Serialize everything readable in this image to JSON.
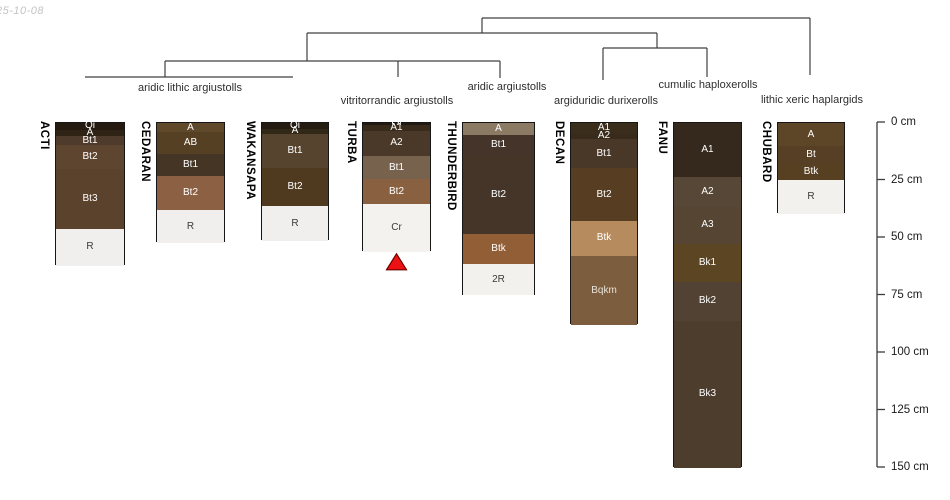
{
  "timestamp": "25-10-08",
  "chart_data": {
    "type": "bar",
    "variant": "soil profile sketches (stacked depth columns) grouped by a taxonomy dendrogram, aqp-style",
    "depth_axis": {
      "unit": "cm",
      "range": [
        0,
        150
      ],
      "ticks": [
        0,
        25,
        50,
        75,
        100,
        125,
        150
      ],
      "tick_labels": [
        "0 cm",
        "25 cm",
        "50 cm",
        "75 cm",
        "100 cm",
        "125 cm",
        "150 cm"
      ]
    },
    "taxa_groups": [
      "aridic lithic argiustolls",
      "vitritorrandic argiustolls",
      "aridic argiustolls",
      "argiduridic durixerolls",
      "cumulic haploxerolls",
      "lithic xeric haplargids"
    ],
    "profiles": [
      {
        "id": "ACTI",
        "group": "aridic lithic argiustolls",
        "x": 55,
        "w": 70,
        "horizons": [
          {
            "name": "Oi",
            "top": 0,
            "bottom": 3,
            "color": "#241a10",
            "text_color": "#ffffff"
          },
          {
            "name": "A",
            "top": 3,
            "bottom": 5.7,
            "color": "#2f2315",
            "text_color": "#ffffff"
          },
          {
            "name": "Bt1",
            "top": 5.7,
            "bottom": 9.7,
            "color": "#4e3b2b",
            "text_color": "#ffffff"
          },
          {
            "name": "Bt2",
            "top": 9.7,
            "bottom": 20,
            "color": "#5e4530",
            "text_color": "#ffffff"
          },
          {
            "name": "Bt3",
            "top": 20,
            "bottom": 46,
            "color": "#5a422d",
            "text_color": "#ffffff"
          },
          {
            "name": "R",
            "top": 46,
            "bottom": 62,
            "color": "#f0efed",
            "text_color": "#3a3a3a"
          }
        ]
      },
      {
        "id": "CEDARAN",
        "group": "aridic lithic argiustolls",
        "x": 156,
        "w": 69,
        "horizons": [
          {
            "name": "A",
            "top": 0,
            "bottom": 4,
            "color": "#60482a",
            "text_color": "#ffffff"
          },
          {
            "name": "AB",
            "top": 4,
            "bottom": 13.5,
            "color": "#564023",
            "text_color": "#ffffff"
          },
          {
            "name": "Bt1",
            "top": 13.5,
            "bottom": 23,
            "color": "#453525",
            "text_color": "#ffffff"
          },
          {
            "name": "Bt2",
            "top": 23,
            "bottom": 38,
            "color": "#8c6143",
            "text_color": "#ffffff"
          },
          {
            "name": "R",
            "top": 38,
            "bottom": 52,
            "color": "#f0efed",
            "text_color": "#3a3a3a"
          }
        ]
      },
      {
        "id": "WAKANSAPA",
        "group": "aridic lithic argiustolls",
        "x": 261,
        "w": 68,
        "horizons": [
          {
            "name": "Oi",
            "top": 0,
            "bottom": 2.5,
            "color": "#241c11",
            "text_color": "#ffffff"
          },
          {
            "name": "A",
            "top": 2.5,
            "bottom": 4.7,
            "color": "#322817",
            "text_color": "#ffffff"
          },
          {
            "name": "Bt1",
            "top": 4.7,
            "bottom": 19.7,
            "color": "#57442f",
            "text_color": "#ffffff"
          },
          {
            "name": "Bt2",
            "top": 19.7,
            "bottom": 36,
            "color": "#4f3a20",
            "text_color": "#ffffff"
          },
          {
            "name": "R",
            "top": 36,
            "bottom": 51.5,
            "color": "#f0efed",
            "text_color": "#3a3a3a"
          }
        ]
      },
      {
        "id": "TURBA",
        "group": "vitritorrandic argiustolls",
        "x": 362,
        "w": 69,
        "horizons": [
          {
            "name": "Oi",
            "top": 0,
            "bottom": 1,
            "color": "#221a10",
            "text_color": "#ffffff"
          },
          {
            "name": "A1",
            "top": 1,
            "bottom": 3.3,
            "color": "#382b1b",
            "text_color": "#ffffff"
          },
          {
            "name": "A2",
            "top": 3.3,
            "bottom": 14.3,
            "color": "#4a3928",
            "text_color": "#ffffff"
          },
          {
            "name": "Bt1",
            "top": 14.3,
            "bottom": 24.5,
            "color": "#77624d",
            "text_color": "#ffffff"
          },
          {
            "name": "Bt2",
            "top": 24.5,
            "bottom": 35.4,
            "color": "#8a6140",
            "text_color": "#ffffff"
          },
          {
            "name": "Cr",
            "top": 35.4,
            "bottom": 56,
            "color": "#f4f2ef",
            "text_color": "#3a3a3a"
          }
        ]
      },
      {
        "id": "THUNDERBIRD",
        "group": "aridic argiustolls",
        "x": 462,
        "w": 73,
        "horizons": [
          {
            "name": "A",
            "top": 0,
            "bottom": 5,
            "color": "#8b7a64",
            "text_color": "#ffffff"
          },
          {
            "name": "Bt1",
            "top": 5,
            "bottom": 14.3,
            "color": "#44342a",
            "text_color": "#ffffff"
          },
          {
            "name": "Bt2",
            "top": 14.3,
            "bottom": 48.4,
            "color": "#453529",
            "text_color": "#ffffff"
          },
          {
            "name": "Btk",
            "top": 48.4,
            "bottom": 61.4,
            "color": "#925e36",
            "text_color": "#ffffff"
          },
          {
            "name": "2R",
            "top": 61.4,
            "bottom": 75,
            "color": "#f2f1ee",
            "text_color": "#3a3a3a"
          }
        ]
      },
      {
        "id": "DECAN",
        "group": "argiduridic durixerolls",
        "x": 570,
        "w": 68,
        "horizons": [
          {
            "name": "A1",
            "top": 0,
            "bottom": 4.6,
            "color": "#3b2d1c",
            "text_color": "#ffffff"
          },
          {
            "name": "A2",
            "top": 4.6,
            "bottom": 7.1,
            "color": "#392b1b",
            "text_color": "#ffffff"
          },
          {
            "name": "Bt1",
            "top": 7.1,
            "bottom": 19.7,
            "color": "#493827",
            "text_color": "#ffffff"
          },
          {
            "name": "Bt2",
            "top": 19.7,
            "bottom": 42.6,
            "color": "#573e22",
            "text_color": "#ffffff"
          },
          {
            "name": "Btk",
            "top": 42.6,
            "bottom": 57.8,
            "color": "#b68b5e",
            "text_color": "#ffffff"
          },
          {
            "name": "Bqkm",
            "top": 57.8,
            "bottom": 88,
            "color": "#7c5d3e",
            "text_color": "#e8e2d8"
          }
        ]
      },
      {
        "id": "FANU",
        "group": "cumulic haploxerolls",
        "x": 673,
        "w": 69,
        "horizons": [
          {
            "name": "A1",
            "top": 0,
            "bottom": 23.3,
            "color": "#35291d",
            "text_color": "#ffffff"
          },
          {
            "name": "A2",
            "top": 23.3,
            "bottom": 36.4,
            "color": "#574737",
            "text_color": "#ffffff"
          },
          {
            "name": "A3",
            "top": 36.4,
            "bottom": 52.7,
            "color": "#554532",
            "text_color": "#ffffff"
          },
          {
            "name": "Bk1",
            "top": 52.7,
            "bottom": 69,
            "color": "#5c4523",
            "text_color": "#ffffff"
          },
          {
            "name": "Bk2",
            "top": 69,
            "bottom": 86,
            "color": "#524233",
            "text_color": "#ffffff"
          },
          {
            "name": "Bk3",
            "top": 86,
            "bottom": 150,
            "color": "#4d3d2d",
            "text_color": "#ffffff"
          }
        ]
      },
      {
        "id": "CHUBARD",
        "group": "lithic xeric haplargids",
        "x": 777,
        "w": 68,
        "horizons": [
          {
            "name": "A",
            "top": 0,
            "bottom": 10,
            "color": "#5d4527",
            "text_color": "#ffffff"
          },
          {
            "name": "Bt",
            "top": 10,
            "bottom": 17.7,
            "color": "#573f26",
            "text_color": "#ffffff"
          },
          {
            "name": "Btk",
            "top": 17.7,
            "bottom": 24.8,
            "color": "#573f22",
            "text_color": "#ffffff"
          },
          {
            "name": "R",
            "top": 24.8,
            "bottom": 39.7,
            "color": "#f2f1ee",
            "text_color": "#3a3a3a"
          }
        ]
      }
    ],
    "dendrogram": {
      "line_color": "#404040",
      "segments": [
        {
          "x1": 482,
          "y1": 18,
          "x2": 810,
          "y2": 18
        },
        {
          "x1": 482,
          "y1": 18,
          "x2": 482,
          "y2": 33
        },
        {
          "x1": 810,
          "y1": 18,
          "x2": 810,
          "y2": 75
        },
        {
          "x1": 307,
          "y1": 33,
          "x2": 657,
          "y2": 33
        },
        {
          "x1": 307,
          "y1": 33,
          "x2": 307,
          "y2": 61
        },
        {
          "x1": 657,
          "y1": 33,
          "x2": 657,
          "y2": 48
        },
        {
          "x1": 165,
          "y1": 61,
          "x2": 500,
          "y2": 61
        },
        {
          "x1": 165,
          "y1": 61,
          "x2": 165,
          "y2": 77
        },
        {
          "x1": 398,
          "y1": 61,
          "x2": 398,
          "y2": 77
        },
        {
          "x1": 500,
          "y1": 61,
          "x2": 500,
          "y2": 78
        },
        {
          "x1": 85,
          "y1": 77,
          "x2": 293,
          "y2": 77
        },
        {
          "x1": 603,
          "y1": 48,
          "x2": 707,
          "y2": 48
        },
        {
          "x1": 603,
          "y1": 48,
          "x2": 603,
          "y2": 80
        },
        {
          "x1": 707,
          "y1": 48,
          "x2": 707,
          "y2": 77
        }
      ],
      "labels": [
        {
          "text": "aridic lithic argiustolls",
          "x": 190,
          "y": 88
        },
        {
          "text": "vitritorrandic argiustolls",
          "x": 397,
          "y": 101
        },
        {
          "text": "aridic argiustolls",
          "x": 507,
          "y": 87
        },
        {
          "text": "argiduridic durixerolls",
          "x": 606,
          "y": 101
        },
        {
          "text": "cumulic haploxerolls",
          "x": 708,
          "y": 85
        },
        {
          "text": "lithic xeric haplargids",
          "x": 812,
          "y": 100
        }
      ]
    },
    "marker": {
      "shape": "filled triangle pointing up",
      "below_profile": "TURBA",
      "fill": "#ee1111",
      "stroke": "#6b0000"
    }
  },
  "layout": {
    "canvas": {
      "w": 950,
      "h": 500
    },
    "scale": {
      "top_y": 122,
      "px_per_cm": 2.3
    },
    "axis": {
      "x": 877,
      "tick_len": 8,
      "label_x": 891,
      "line_color": "#3c3c3c"
    }
  }
}
